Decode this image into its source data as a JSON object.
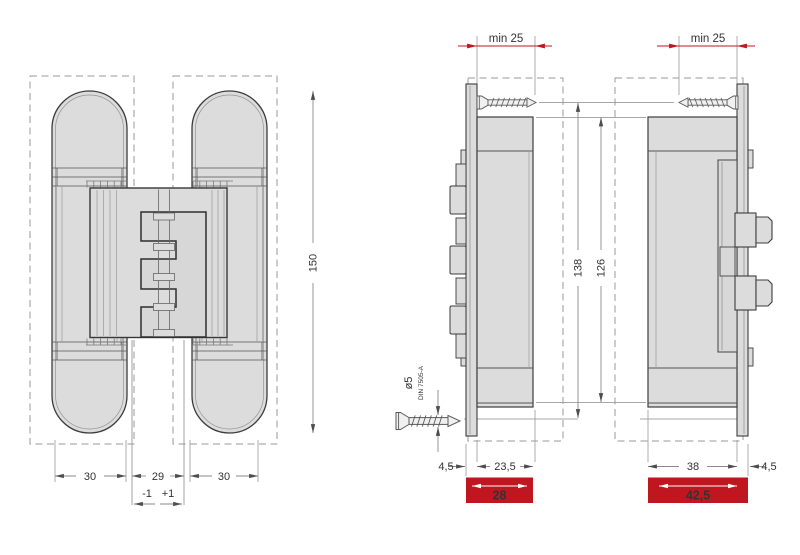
{
  "colors": {
    "red": "#c0161f",
    "part_fill": "#dcdcdc",
    "outline": "#3c3c3c",
    "dim_line": "#8a8a8a",
    "dim_text": "#333333"
  },
  "front_view": {
    "dim_left": "30",
    "dim_gap": "29",
    "dim_right": "30",
    "dim_height": "150",
    "tol_minus": "-1",
    "tol_plus": "+1"
  },
  "frame_section": {
    "min_depth": "min 25",
    "body_depth": "23,5",
    "plate_offset": "4,5",
    "total_depth": "28"
  },
  "door_section": {
    "min_depth": "min 25",
    "body_depth": "38",
    "plate_offset": "4,5",
    "total_depth": "42,5"
  },
  "vertical_dims": {
    "screw_span": "138",
    "body_span": "126"
  },
  "screw_note": {
    "diameter": "ø5",
    "standard": "DIN 7505-A"
  }
}
